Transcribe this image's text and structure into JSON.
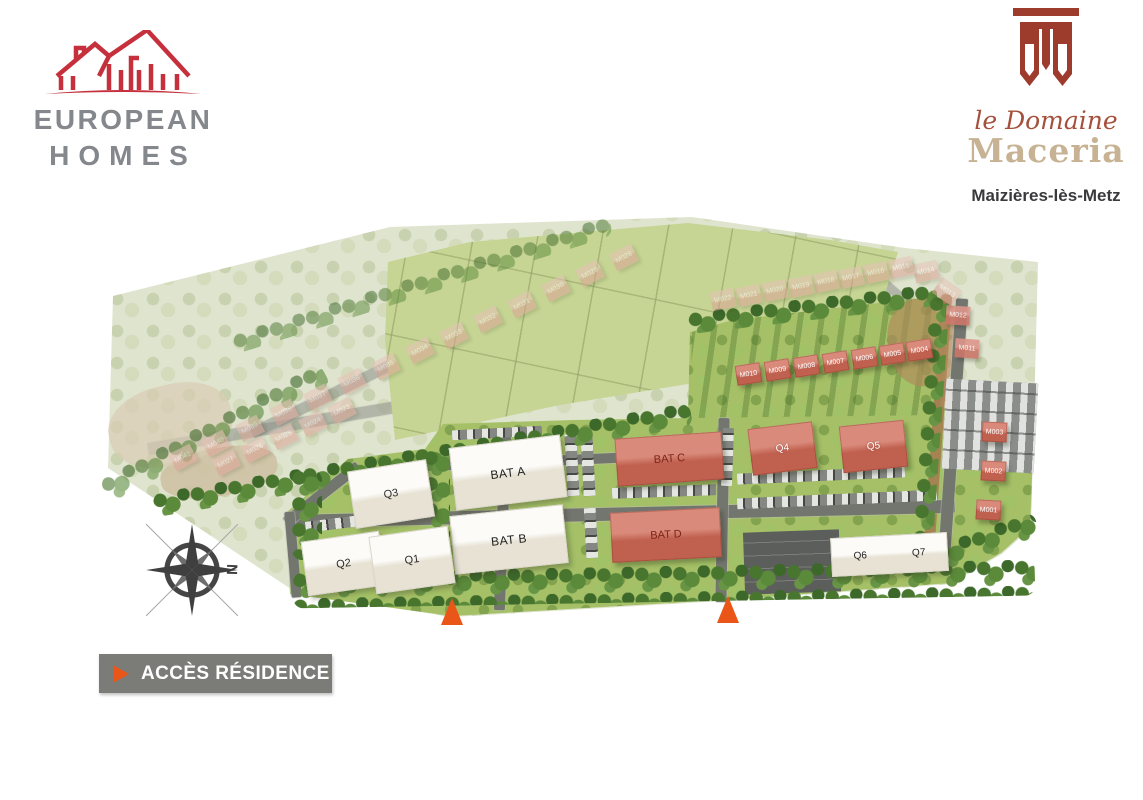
{
  "header": {
    "developer": {
      "line1": "EUROPEAN",
      "line2": "HOMES"
    },
    "project": {
      "script": "le Domaine",
      "name": "Maceria",
      "city": "Maizières-lès-Metz"
    }
  },
  "access": {
    "label": "ACCÈS RÉSIDENCE"
  },
  "compass": {
    "north": "N"
  },
  "colors": {
    "brand_red": "#c5303c",
    "brand_gray": "#84878b",
    "emblem_red": "#9d3b2c",
    "project_gold": "#c7b394",
    "project_script_red": "#a5503b",
    "access_orange": "#e95617",
    "legend_gray": "#7b7b78",
    "active_green": "#a5c066",
    "faded_green": "#dfe4ce",
    "roof_red": "#c0604f"
  },
  "plan": {
    "buildings": [
      {
        "label": "BAT A",
        "type": "white-lg",
        "x": 452,
        "y": 441,
        "w": 112,
        "h": 63,
        "rot": -7
      },
      {
        "label": "BAT B",
        "type": "white-lg",
        "x": 452,
        "y": 510,
        "w": 114,
        "h": 59,
        "rot": -6
      },
      {
        "label": "BAT C",
        "type": "red-lg",
        "x": 616,
        "y": 435,
        "w": 107,
        "h": 48,
        "rot": -4
      },
      {
        "label": "BAT D",
        "type": "red-lg",
        "x": 611,
        "y": 510,
        "w": 110,
        "h": 50,
        "rot": -3
      },
      {
        "label": "Q3",
        "type": "white-md",
        "x": 351,
        "y": 465,
        "w": 80,
        "h": 58,
        "rot": -9
      },
      {
        "label": "Q2",
        "type": "white-md",
        "x": 304,
        "y": 536,
        "w": 79,
        "h": 55,
        "rot": -8
      },
      {
        "label": "Q1",
        "type": "white-md",
        "x": 372,
        "y": 531,
        "w": 80,
        "h": 58,
        "rot": -8
      },
      {
        "label": "Q4",
        "type": "red-md",
        "x": 750,
        "y": 425,
        "w": 65,
        "h": 47,
        "rot": -7
      },
      {
        "label": "Q5",
        "type": "red-md",
        "x": 841,
        "y": 423,
        "w": 65,
        "h": 47,
        "rot": -6
      },
      {
        "label": "Q6",
        "label2": "Q7",
        "type": "white-sm2",
        "x": 831,
        "y": 535,
        "w": 117,
        "h": 39,
        "rot": -3
      },
      {
        "label": "M010",
        "type": "red-sm",
        "x": 736,
        "y": 364,
        "w": 25,
        "h": 20,
        "rot": -9
      },
      {
        "label": "M009",
        "type": "red-sm",
        "x": 765,
        "y": 360,
        "w": 25,
        "h": 20,
        "rot": -9
      },
      {
        "label": "M008",
        "type": "red-sm",
        "x": 794,
        "y": 356,
        "w": 25,
        "h": 20,
        "rot": -9
      },
      {
        "label": "M007",
        "type": "red-sm",
        "x": 823,
        "y": 352,
        "w": 25,
        "h": 20,
        "rot": -9
      },
      {
        "label": "M006",
        "type": "red-sm",
        "x": 852,
        "y": 348,
        "w": 25,
        "h": 20,
        "rot": -9
      },
      {
        "label": "M005",
        "type": "red-sm",
        "x": 880,
        "y": 344,
        "w": 25,
        "h": 20,
        "rot": -9
      },
      {
        "label": "M004",
        "type": "red-sm",
        "x": 907,
        "y": 340,
        "w": 25,
        "h": 20,
        "rot": -9
      },
      {
        "label": "M003",
        "type": "red-sm",
        "x": 982,
        "y": 422,
        "w": 25,
        "h": 20,
        "rot": 3
      },
      {
        "label": "M002",
        "type": "red-sm",
        "x": 981,
        "y": 461,
        "w": 25,
        "h": 20,
        "rot": 3
      },
      {
        "label": "M001",
        "type": "red-sm",
        "x": 976,
        "y": 500,
        "w": 25,
        "h": 20,
        "rot": 3
      },
      {
        "label": "M011",
        "type": "pink-sm",
        "x": 955,
        "y": 339,
        "w": 24,
        "h": 19,
        "rot": 4
      },
      {
        "label": "M012",
        "type": "pink-sm",
        "x": 946,
        "y": 306,
        "w": 24,
        "h": 19,
        "rot": 4
      },
      {
        "label": "M013",
        "type": "faded-sm",
        "x": 935,
        "y": 282,
        "w": 24,
        "h": 19,
        "rot": 35
      },
      {
        "label": "M014",
        "type": "faded-sm",
        "x": 914,
        "y": 262,
        "w": 24,
        "h": 19,
        "rot": -12
      },
      {
        "label": "M015",
        "type": "faded-sm",
        "x": 889,
        "y": 258,
        "w": 24,
        "h": 19,
        "rot": -12
      },
      {
        "label": "M016",
        "type": "faded-sm",
        "x": 864,
        "y": 263,
        "w": 24,
        "h": 19,
        "rot": -12
      },
      {
        "label": "M017",
        "type": "faded-sm",
        "x": 839,
        "y": 268,
        "w": 24,
        "h": 19,
        "rot": -12
      },
      {
        "label": "M018",
        "type": "faded-sm",
        "x": 814,
        "y": 272,
        "w": 24,
        "h": 19,
        "rot": -12
      },
      {
        "label": "M019",
        "type": "faded-sm",
        "x": 789,
        "y": 277,
        "w": 24,
        "h": 19,
        "rot": -12
      },
      {
        "label": "M020",
        "type": "faded-sm",
        "x": 763,
        "y": 281,
        "w": 24,
        "h": 19,
        "rot": -12
      },
      {
        "label": "M021",
        "type": "faded-sm",
        "x": 737,
        "y": 286,
        "w": 24,
        "h": 19,
        "rot": -12
      },
      {
        "label": "M022",
        "type": "faded-sm",
        "x": 711,
        "y": 290,
        "w": 24,
        "h": 19,
        "rot": -12
      },
      {
        "label": "M023",
        "type": "faded-sm",
        "x": 330,
        "y": 401,
        "w": 24,
        "h": 19,
        "rot": -27
      },
      {
        "label": "M024",
        "type": "faded-sm",
        "x": 301,
        "y": 414,
        "w": 24,
        "h": 19,
        "rot": -27
      },
      {
        "label": "M025",
        "type": "faded-sm",
        "x": 272,
        "y": 427,
        "w": 24,
        "h": 19,
        "rot": -27
      },
      {
        "label": "M026",
        "type": "faded-sm",
        "x": 243,
        "y": 440,
        "w": 24,
        "h": 19,
        "rot": -27
      },
      {
        "label": "M027",
        "type": "faded-sm",
        "x": 214,
        "y": 453,
        "w": 24,
        "h": 19,
        "rot": -27
      },
      {
        "label": "M028",
        "type": "faded-sm",
        "x": 612,
        "y": 248,
        "w": 24,
        "h": 19,
        "rot": -27
      },
      {
        "label": "M029",
        "type": "faded-sm",
        "x": 578,
        "y": 264,
        "w": 24,
        "h": 19,
        "rot": -27
      },
      {
        "label": "M030",
        "type": "faded-sm",
        "x": 544,
        "y": 279,
        "w": 24,
        "h": 19,
        "rot": -27
      },
      {
        "label": "M031",
        "type": "faded-sm",
        "x": 510,
        "y": 295,
        "w": 24,
        "h": 19,
        "rot": -27
      },
      {
        "label": "M032",
        "type": "faded-sm",
        "x": 476,
        "y": 310,
        "w": 24,
        "h": 19,
        "rot": -27
      },
      {
        "label": "M033",
        "type": "faded-sm",
        "x": 442,
        "y": 326,
        "w": 24,
        "h": 19,
        "rot": -27
      },
      {
        "label": "M034",
        "type": "faded-sm",
        "x": 408,
        "y": 341,
        "w": 24,
        "h": 19,
        "rot": -27
      },
      {
        "label": "M035",
        "type": "faded-sm",
        "x": 374,
        "y": 357,
        "w": 24,
        "h": 19,
        "rot": -27
      },
      {
        "label": "M036",
        "type": "faded-sm",
        "x": 340,
        "y": 372,
        "w": 24,
        "h": 19,
        "rot": -27
      },
      {
        "label": "M037",
        "type": "faded-sm",
        "x": 306,
        "y": 388,
        "w": 24,
        "h": 19,
        "rot": -27
      },
      {
        "label": "M038",
        "type": "faded-sm",
        "x": 272,
        "y": 403,
        "w": 24,
        "h": 19,
        "rot": -27
      },
      {
        "label": "M039",
        "type": "faded-sm",
        "x": 238,
        "y": 419,
        "w": 24,
        "h": 19,
        "rot": -27
      },
      {
        "label": "M040",
        "type": "faded-sm",
        "x": 204,
        "y": 434,
        "w": 24,
        "h": 19,
        "rot": -27
      },
      {
        "label": "M041",
        "type": "faded-sm",
        "x": 171,
        "y": 448,
        "w": 24,
        "h": 19,
        "rot": -27
      }
    ]
  }
}
